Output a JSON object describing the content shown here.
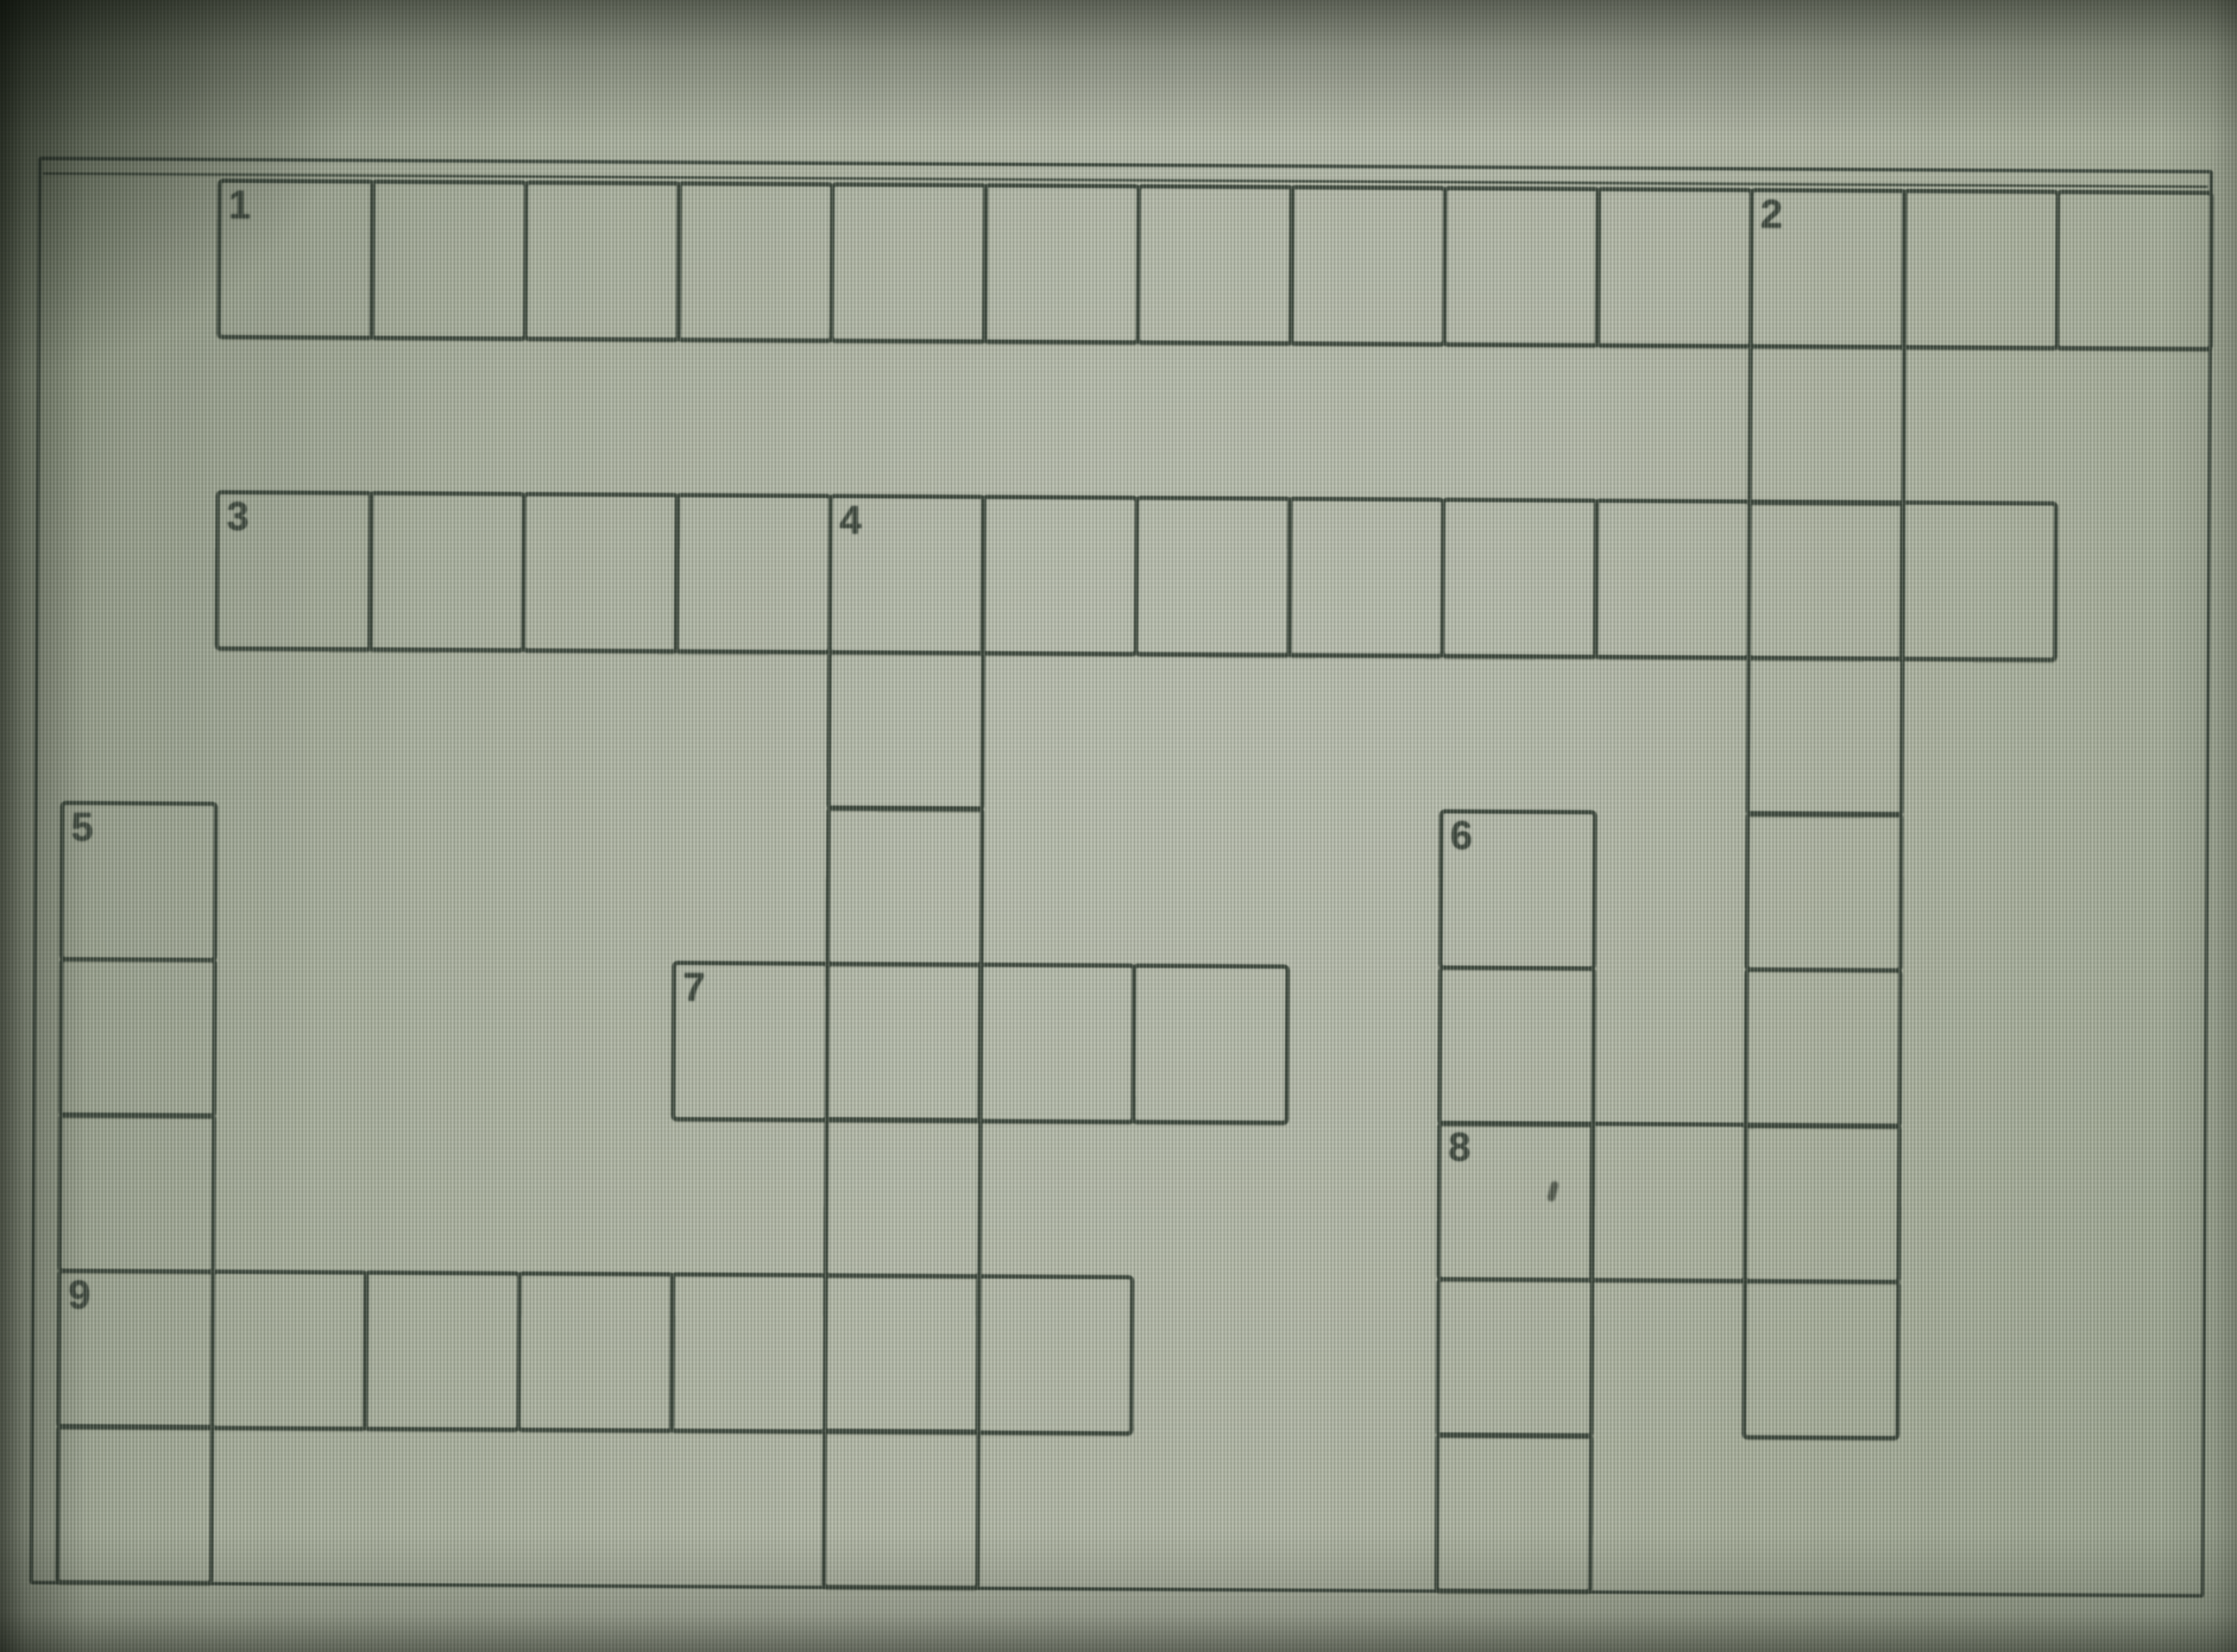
{
  "app": {
    "description": "Photograph of a computer screen displaying an empty crossword puzzle grid with numbered cells"
  },
  "board": {
    "grid": {
      "rows": 9,
      "cols": 14
    },
    "numbers": [
      "1",
      "2",
      "3",
      "4",
      "5",
      "6",
      "7",
      "8",
      "9"
    ],
    "entries": [
      {
        "number": "1",
        "direction": "across",
        "row": 0,
        "col": 1,
        "length": 13,
        "value": ""
      },
      {
        "number": "2",
        "direction": "down",
        "row": 0,
        "col": 11,
        "length": 8,
        "value": ""
      },
      {
        "number": "3",
        "direction": "across",
        "row": 2,
        "col": 1,
        "length": 12,
        "value": ""
      },
      {
        "number": "4",
        "direction": "down",
        "row": 2,
        "col": 5,
        "length": 7,
        "value": ""
      },
      {
        "number": "5",
        "direction": "down",
        "row": 4,
        "col": 0,
        "length": 5,
        "value": ""
      },
      {
        "number": "6",
        "direction": "down",
        "row": 4,
        "col": 9,
        "length": 5,
        "value": ""
      },
      {
        "number": "7",
        "direction": "across",
        "row": 5,
        "col": 4,
        "length": 4,
        "value": ""
      },
      {
        "number": "8",
        "direction": "across",
        "row": 6,
        "col": 9,
        "length": 3,
        "value": ""
      },
      {
        "number": "9",
        "direction": "across",
        "row": 7,
        "col": 0,
        "length": 7,
        "value": ""
      }
    ]
  },
  "colors": {
    "background": "#a9b0a0",
    "grid_line": "#3a453a",
    "digit": "#3c463c",
    "edge_shadow": "#0a0e08"
  }
}
